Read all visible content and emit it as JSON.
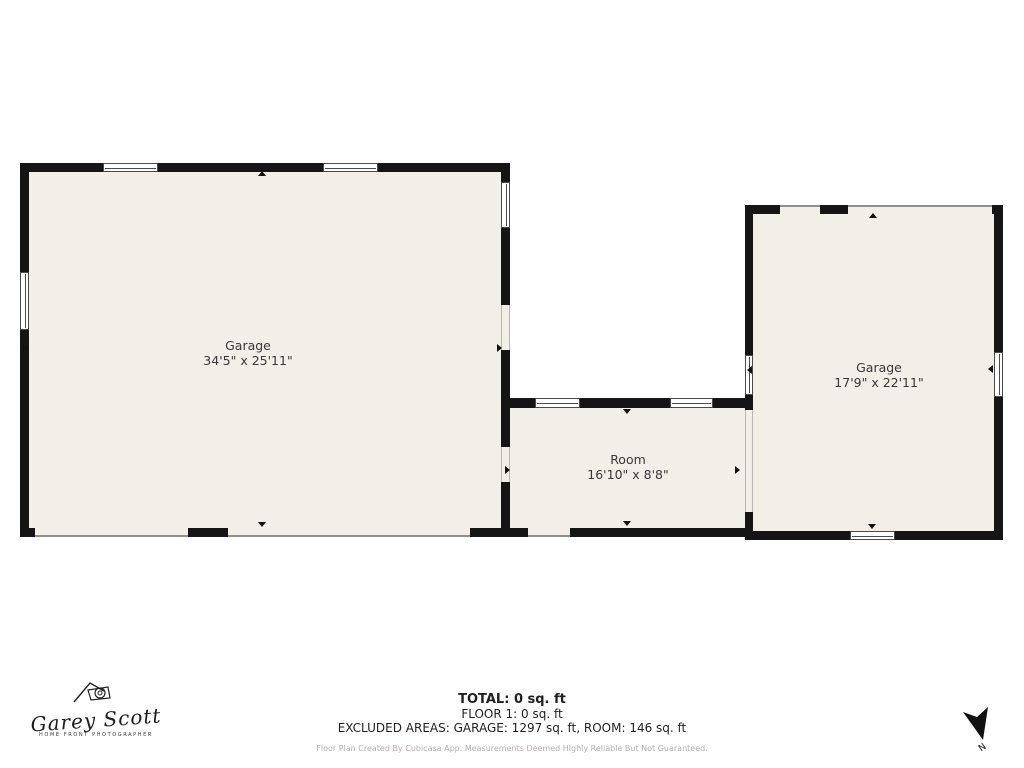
{
  "floorplan": {
    "rooms": [
      {
        "name": "Garage",
        "dimensions": "34'5\" x 25'11\""
      },
      {
        "name": "Room",
        "dimensions": "16'10\" x 8'8\""
      },
      {
        "name": "Garage",
        "dimensions": "17'9\" x 22'11\""
      }
    ]
  },
  "footer": {
    "total": "TOTAL: 0 sq. ft",
    "floor": "FLOOR 1: 0 sq. ft",
    "excluded": "EXCLUDED AREAS: GARAGE: 1297 sq. ft, ROOM: 146 sq. ft",
    "disclaimer": "Floor Plan Created By Cubicasa App. Measurements Deemed Highly Reliable But Not Guaranteed."
  },
  "logo": {
    "name": "Garey Scott",
    "tagline": "HOME FRONT PHOTOGRAPHER"
  },
  "compass": {
    "label": "N"
  },
  "colors": {
    "wall": "#151515",
    "floor": "#f2eee8",
    "background": "#ffffff",
    "text": "#383838",
    "disclaimer": "#b5b0ad"
  }
}
